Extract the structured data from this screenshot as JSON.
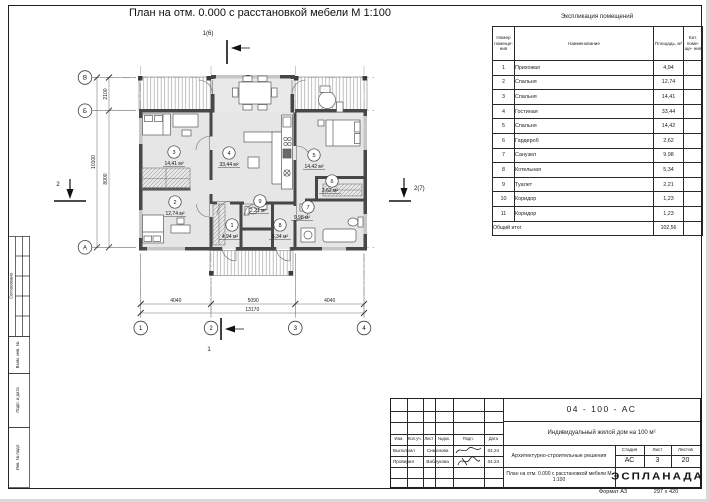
{
  "sheet": {
    "title": "План на отм. 0.000 с расстановкой мебели М 1:100",
    "format_label": "Формат А3",
    "format_size": "297 х 420"
  },
  "plan": {
    "axes_horizontal": [
      "1",
      "2",
      "3",
      "4"
    ],
    "axes_vertical": [
      "В",
      "Б",
      "А"
    ],
    "dims_bottom": [
      "4040",
      "5090",
      "4040"
    ],
    "dim_bottom_total": "13170",
    "dims_left": [
      "2100",
      "8000"
    ],
    "dim_left_total": "10100",
    "section_marks": {
      "top": "1(6)",
      "bottom": "1",
      "left": "2",
      "right": "2(7)"
    },
    "rooms": [
      {
        "num": "1",
        "area": "4,94 м²",
        "x": 202,
        "y": 207,
        "ax": 200,
        "ay": 220
      },
      {
        "num": "2",
        "area": "12,74 м²",
        "x": 145,
        "y": 184,
        "ax": 145,
        "ay": 197
      },
      {
        "num": "3",
        "area": "14,41 м²",
        "x": 144,
        "y": 134,
        "ax": 144,
        "ay": 147
      },
      {
        "num": "4",
        "area": "33,44 м²",
        "x": 199,
        "y": 135,
        "ax": 199,
        "ay": 148
      },
      {
        "num": "5",
        "area": "14,42 м²",
        "x": 284,
        "y": 137,
        "ax": 284,
        "ay": 150
      },
      {
        "num": "6",
        "area": "2,62 м²",
        "x": 302,
        "y": 163,
        "ax": 300,
        "ay": 174
      },
      {
        "num": "7",
        "area": "9,98 м²",
        "x": 278,
        "y": 189,
        "ax": 272,
        "ay": 201
      },
      {
        "num": "8",
        "area": "5,34 м²",
        "x": 250,
        "y": 207,
        "ax": 250,
        "ay": 220
      },
      {
        "num": "9",
        "area": "2,21 м²",
        "x": 230,
        "y": 183,
        "ax": 228,
        "ay": 194
      }
    ]
  },
  "explication": {
    "title": "Экспликация помещений",
    "headers": {
      "num": "Номер помеще- ния",
      "name": "Наименование",
      "area": "Площадь, м²",
      "cat": "Кат. поме- ще- ния"
    },
    "rows": [
      {
        "num": "1",
        "name": "Прихожая",
        "area": "4,94",
        "cat": ""
      },
      {
        "num": "2",
        "name": "Спальня",
        "area": "12,74",
        "cat": ""
      },
      {
        "num": "3",
        "name": "Спальня",
        "area": "14,41",
        "cat": ""
      },
      {
        "num": "4",
        "name": "Гостиная",
        "area": "33,44",
        "cat": ""
      },
      {
        "num": "5",
        "name": "Спальня",
        "area": "14,42",
        "cat": ""
      },
      {
        "num": "6",
        "name": "Гардероб",
        "area": "2,62",
        "cat": ""
      },
      {
        "num": "7",
        "name": "Санузел",
        "area": "9,98",
        "cat": ""
      },
      {
        "num": "8",
        "name": "Котельная",
        "area": "5,34",
        "cat": ""
      },
      {
        "num": "9",
        "name": "Туалет",
        "area": "2,21",
        "cat": ""
      },
      {
        "num": "10",
        "name": "Коридор",
        "area": "1,23",
        "cat": ""
      },
      {
        "num": "11",
        "name": "Коридор",
        "area": "1,23",
        "cat": ""
      }
    ],
    "total_label": "Общий итог",
    "total_value": "102,56"
  },
  "titleblock": {
    "doc_number": "04 - 100 - АС",
    "project": "Индивидуальный жилой дом на 100 м²",
    "section": "Архитектурно-строительные решения",
    "drawing_title": "План на отм. 0.000 с расстановкой мебели М 1:100",
    "cols": [
      "Изм.",
      "Кол.уч.",
      "Лист",
      "№док.",
      "Подп.",
      "Дата"
    ],
    "roles": [
      {
        "role": "Выполнил",
        "name": "Симонова",
        "date": "04.24"
      },
      {
        "role": "Проверил",
        "name": "Ваблукова",
        "date": "04.24"
      }
    ],
    "stage_label": "Стадия",
    "sheet_label": "Лист",
    "sheets_label": "Листов",
    "stage": "АС",
    "sheet_num": "3",
    "sheets_total": "20",
    "brand": "ЭСПЛАНАДА"
  },
  "side_strip": {
    "labels": [
      "Согласовано",
      "Взам. инв. №",
      "Подп. и дата",
      "Инв. № подл."
    ]
  }
}
